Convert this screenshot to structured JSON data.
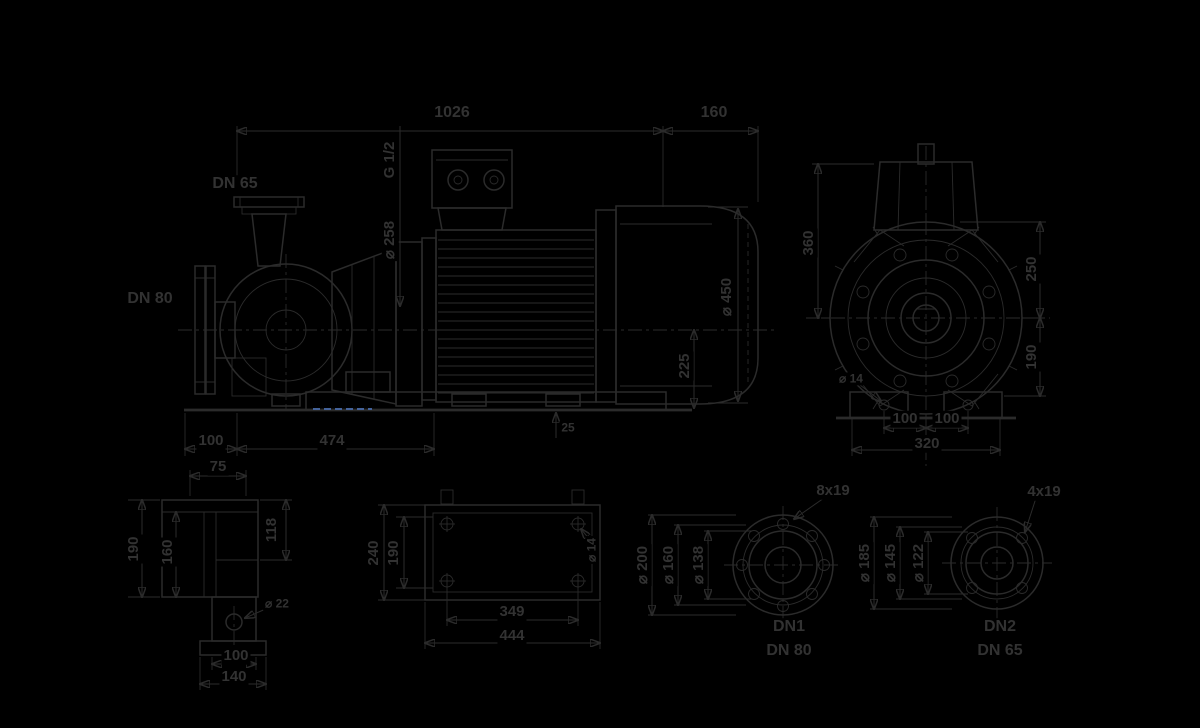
{
  "meta": {
    "description": "Dimensional drawing of an end-suction centrifugal pump with electric motor, with end view, foot detail, baseplate plan and two flange details",
    "background_color": "#000000",
    "line_color": "#2b2b2b",
    "text_color": "#323232",
    "accent_color": "#44639b"
  },
  "side": {
    "total_length": "1026",
    "fan_overhang": "160",
    "discharge": "DN 65",
    "suction": "DN 80",
    "vent_port": "G 1/2",
    "casing_dia": "⌀ 258",
    "fan_dia": "⌀ 450",
    "axis_to_base": "225",
    "foot_offset": "100",
    "foot_span": "474",
    "plate_height": "25"
  },
  "end": {
    "axis_to_top": "360",
    "top_to_axis": "250",
    "axis_to_foot": "190",
    "foot_left": "100",
    "foot_right": "100",
    "foot_total": "320",
    "foot_hole": "⌀ 14"
  },
  "foot": {
    "width_top": "75",
    "height_outer": "190",
    "height_inner": "160",
    "height_right": "118",
    "hole": "⌀ 22",
    "base_inner": "100",
    "base_outer": "140"
  },
  "plate": {
    "height_outer": "240",
    "height_inner": "190",
    "hole": "⌀ 14",
    "length_inner": "349",
    "length_outer": "444"
  },
  "flange1": {
    "bolt_holes": "8x19",
    "outer_dia": "⌀ 200",
    "bolt_circle": "⌀ 160",
    "face_dia": "⌀ 138",
    "port": "DN1",
    "size": "DN 80"
  },
  "flange2": {
    "bolt_holes": "4x19",
    "outer_dia": "⌀ 185",
    "bolt_circle": "⌀ 145",
    "face_dia": "⌀ 122",
    "port": "DN2",
    "size": "DN 65"
  }
}
